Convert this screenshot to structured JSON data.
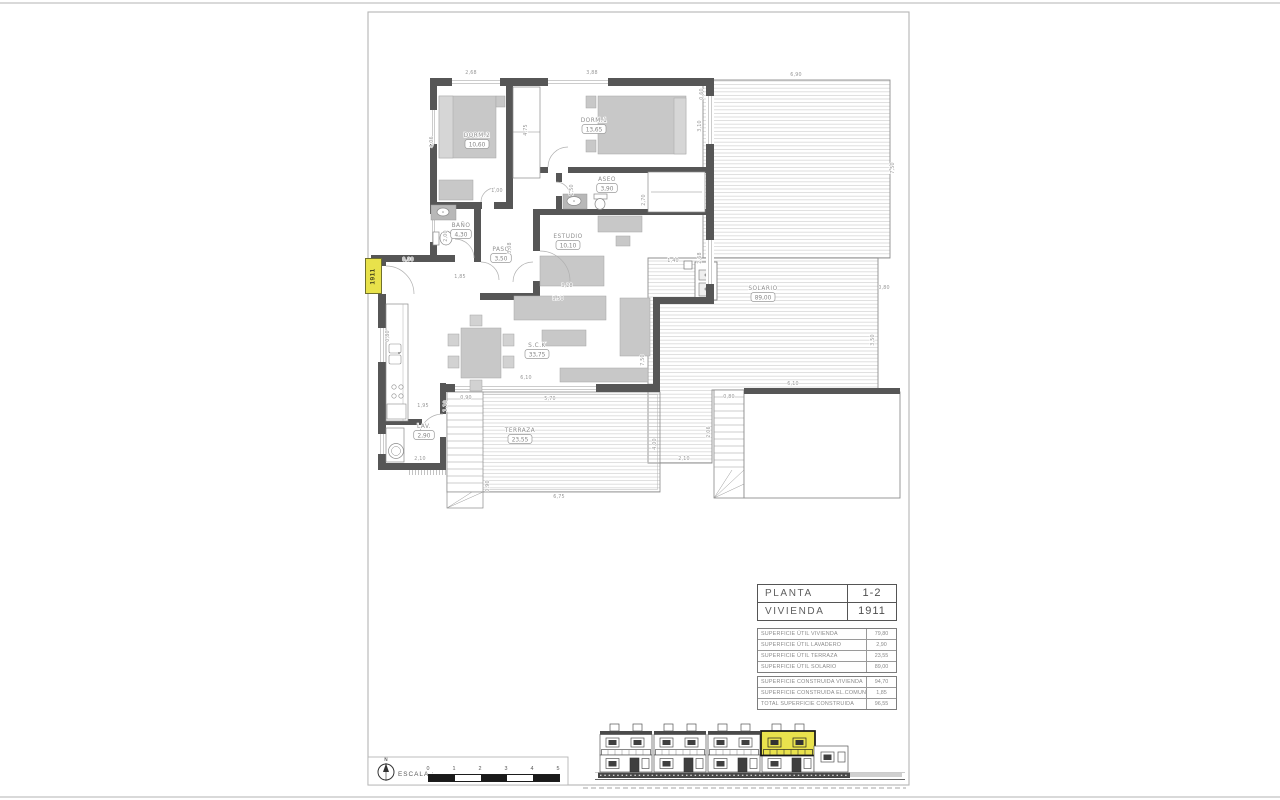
{
  "sheet": {
    "background": "#ffffff",
    "frame_color": "#b5b5b5"
  },
  "entry_tag": "1911",
  "north_label": "N",
  "scale_bar": {
    "label": "ESCALA :",
    "ticks": [
      "0",
      "1",
      "2",
      "3",
      "4",
      "5"
    ]
  },
  "title_table": {
    "rows": [
      {
        "label": "PLANTA",
        "value": "1-2"
      },
      {
        "label": "VIVIENDA",
        "value": "1911"
      }
    ]
  },
  "surface_tables": [
    {
      "rows": [
        {
          "label": "SUPERFICIE ÚTIL VIVIENDA",
          "value": "79,80"
        },
        {
          "label": "SUPERFICIE ÚTIL LAVADERO",
          "value": "2,90"
        },
        {
          "label": "SUPERFICIE ÚTIL TERRAZA",
          "value": "23,55"
        },
        {
          "label": "SUPERFICIE ÚTIL SOLARIO",
          "value": "89,00"
        }
      ]
    },
    {
      "rows": [
        {
          "label": "SUPERFICIE CONSTRUIDA VIVIENDA",
          "value": "94,70"
        },
        {
          "label": "SUPERFICIE CONSTRUIDA EL.COMUNES",
          "value": "1,85"
        },
        {
          "label": "TOTAL SUPERFICIE CONSTRUIDA",
          "value": "96,55"
        }
      ]
    }
  ],
  "rooms": [
    {
      "name": "DORM.2",
      "area": "10,60",
      "x": 477,
      "y": 137
    },
    {
      "name": "DORM.1",
      "area": "13,65",
      "x": 594,
      "y": 122
    },
    {
      "name": "ASEO",
      "area": "3,90",
      "x": 607,
      "y": 181
    },
    {
      "name": "BAÑO",
      "area": "4,30",
      "x": 461,
      "y": 227
    },
    {
      "name": "PASO",
      "area": "3,50",
      "x": 501,
      "y": 251
    },
    {
      "name": "ESTUDIO",
      "area": "10,10",
      "x": 568,
      "y": 238
    },
    {
      "name": "S.C.K",
      "area": "33,75",
      "x": 537,
      "y": 347
    },
    {
      "name": "LAV.",
      "area": "2,90",
      "x": 424,
      "y": 428
    },
    {
      "name": "TERRAZA",
      "area": "23,55",
      "x": 520,
      "y": 432
    },
    {
      "name": "SOLARIO",
      "area": "89,00",
      "x": 763,
      "y": 290
    }
  ],
  "dims": [
    {
      "t": "2,68",
      "x": 471,
      "y": 74
    },
    {
      "t": "3,88",
      "x": 592,
      "y": 74
    },
    {
      "t": "4,06",
      "x": 433,
      "y": 142,
      "r": 1
    },
    {
      "t": "4,75",
      "x": 527,
      "y": 130,
      "r": 1
    },
    {
      "t": "3,10",
      "x": 701,
      "y": 126,
      "r": 1
    },
    {
      "t": "1,00",
      "x": 497,
      "y": 192
    },
    {
      "t": "1,50",
      "x": 573,
      "y": 190,
      "r": 1
    },
    {
      "t": "2,70",
      "x": 645,
      "y": 200,
      "r": 1
    },
    {
      "t": "2,00",
      "x": 447,
      "y": 236,
      "r": 1
    },
    {
      "t": "1,85",
      "x": 460,
      "y": 278
    },
    {
      "t": "3,08",
      "x": 511,
      "y": 248,
      "r": 1
    },
    {
      "t": "0,90",
      "x": 408,
      "y": 261
    },
    {
      "t": "2,68",
      "x": 701,
      "y": 258,
      "r": 1
    },
    {
      "t": "3,28",
      "x": 567,
      "y": 287
    },
    {
      "t": "3,50",
      "x": 558,
      "y": 300
    },
    {
      "t": "0,80",
      "x": 389,
      "y": 336,
      "r": 1
    },
    {
      "t": "6,10",
      "x": 526,
      "y": 379
    },
    {
      "t": "5,70",
      "x": 550,
      "y": 400
    },
    {
      "t": "0,90",
      "x": 466,
      "y": 399
    },
    {
      "t": "1,10",
      "x": 447,
      "y": 406,
      "r": 1
    },
    {
      "t": "1,95",
      "x": 423,
      "y": 407
    },
    {
      "t": "2,10",
      "x": 420,
      "y": 460
    },
    {
      "t": "4,00",
      "x": 656,
      "y": 444,
      "r": 1
    },
    {
      "t": "0,90",
      "x": 489,
      "y": 486,
      "r": 1
    },
    {
      "t": "6,75",
      "x": 559,
      "y": 498
    },
    {
      "t": "6,90",
      "x": 796,
      "y": 76
    },
    {
      "t": "0,60",
      "x": 703,
      "y": 94,
      "r": 1
    },
    {
      "t": "7,50",
      "x": 894,
      "y": 168,
      "r": 1
    },
    {
      "t": "1,40",
      "x": 673,
      "y": 262
    },
    {
      "t": "0,80",
      "x": 884,
      "y": 289
    },
    {
      "t": "3,50",
      "x": 874,
      "y": 340,
      "r": 1
    },
    {
      "t": "7,50",
      "x": 644,
      "y": 360,
      "r": 1
    },
    {
      "t": "6,10",
      "x": 793,
      "y": 385
    },
    {
      "t": "0,80",
      "x": 729,
      "y": 398
    },
    {
      "t": "2,06",
      "x": 710,
      "y": 432,
      "r": 1
    },
    {
      "t": "2,10",
      "x": 684,
      "y": 460
    }
  ],
  "colors": {
    "wall": "#565656",
    "furniture": "#c8c8c8",
    "hatch_line": "#c9c9c9",
    "highlight_yellow": "#e9e24d",
    "tag_yellow": "#e8e24b",
    "drawing_line": "#8a8a8a",
    "text_gray": "#8f8f8f"
  }
}
